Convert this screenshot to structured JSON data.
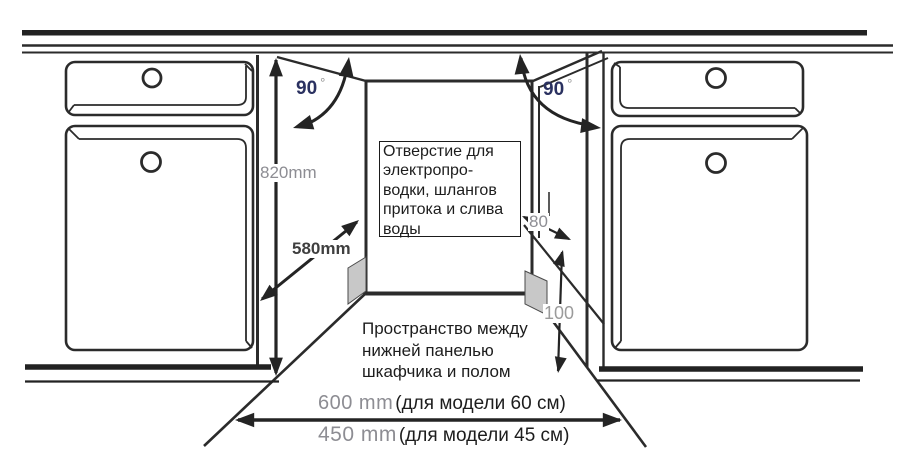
{
  "diagram": {
    "dimensions": {
      "height": "820mm",
      "depth": "580mm",
      "angle_left": "90",
      "angle_right": "90",
      "degree_symbol": "°",
      "hole_size": "80",
      "floor_clearance": "100",
      "width_60": "600 mm",
      "width_60_note": "(для модели 60 см)",
      "width_45": "450 mm",
      "width_45_note": "(для модели 45 см)"
    },
    "opening_note": [
      "Отверстие для",
      "электропро-",
      "водки, шлангов",
      "притока и слива",
      "воды"
    ],
    "floor_note": [
      "Пространство между",
      "нижней панелью",
      "шкафчика и полом"
    ],
    "colors": {
      "line": "#2b2b2b",
      "dimension_text": "#8d8d93",
      "angle_text": "#2a3160",
      "text": "#1d1d1d",
      "hole_fill": "#c8c8c8"
    }
  }
}
